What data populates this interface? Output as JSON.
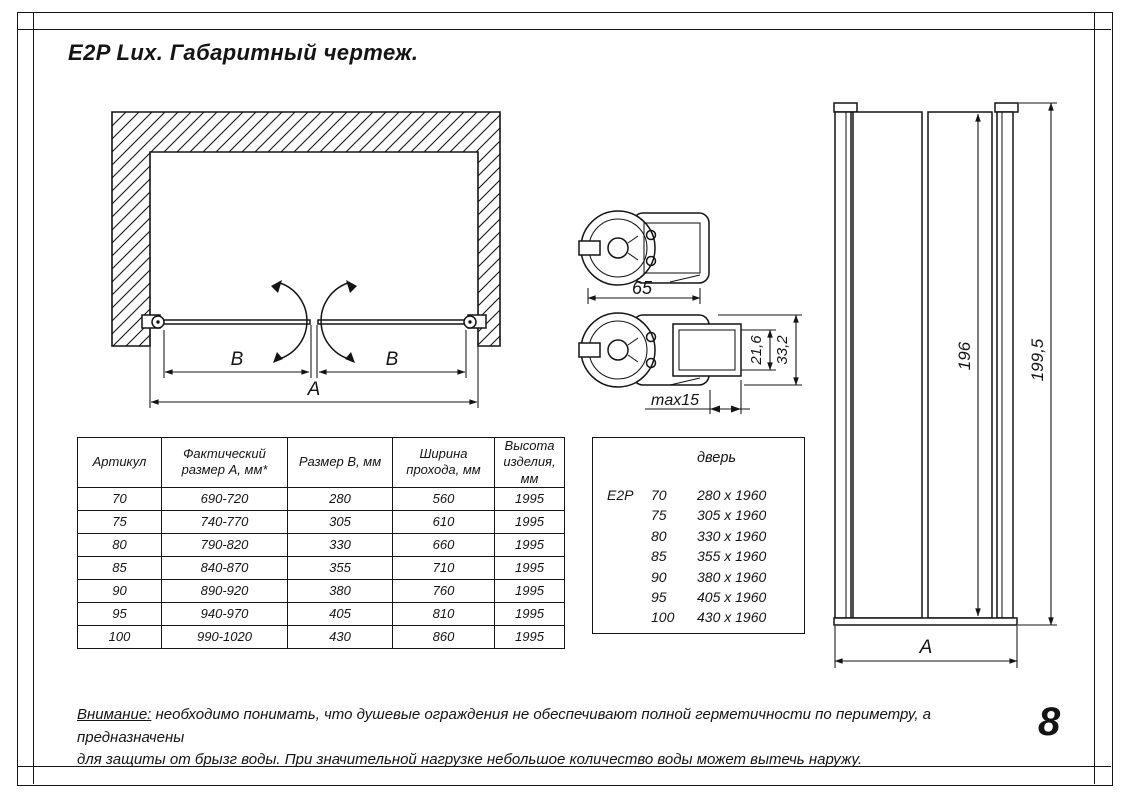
{
  "title": "E2P Lux. Габаритный чертеж.",
  "page_number": "8",
  "plan_view": {
    "dim_b_left": "B",
    "dim_b_right": "B",
    "dim_a": "A"
  },
  "profile_top": {
    "width_dim": "65"
  },
  "profile_bottom": {
    "inner_dim": "21,6",
    "outer_dim": "33,2",
    "adjust_dim": "max15"
  },
  "elevation": {
    "inner_height_dim": "196",
    "total_height_dim": "199,5",
    "width_dim": "A"
  },
  "spec_table": {
    "headers": [
      "Артикул",
      "Фактический размер А, мм*",
      "Размер В, мм",
      "Ширина прохода, мм",
      "Высота изделия, мм"
    ],
    "rows": [
      [
        "70",
        "690-720",
        "280",
        "560",
        "1995"
      ],
      [
        "75",
        "740-770",
        "305",
        "610",
        "1995"
      ],
      [
        "80",
        "790-820",
        "330",
        "660",
        "1995"
      ],
      [
        "85",
        "840-870",
        "355",
        "710",
        "1995"
      ],
      [
        "90",
        "890-920",
        "380",
        "760",
        "1995"
      ],
      [
        "95",
        "940-970",
        "405",
        "810",
        "1995"
      ],
      [
        "100",
        "990-1020",
        "430",
        "860",
        "1995"
      ]
    ]
  },
  "door_table": {
    "header": "дверь",
    "series": "E2P",
    "rows": [
      {
        "size": "70",
        "dims": "280 x 1960"
      },
      {
        "size": "75",
        "dims": "305 x 1960"
      },
      {
        "size": "80",
        "dims": "330 x 1960"
      },
      {
        "size": "85",
        "dims": "355 x 1960"
      },
      {
        "size": "90",
        "dims": "380 x 1960"
      },
      {
        "size": "95",
        "dims": "405 x 1960"
      },
      {
        "size": "100",
        "dims": "430 x 1960"
      }
    ]
  },
  "warning": {
    "label": "Внимание:",
    "line1": " необходимо понимать, что душевые ограждения не обеспечивают полной герметичности по периметру, а предназначены",
    "line2": "для защиты от брызг воды. При значительной нагрузке небольшое количество воды может вытечь наружу."
  }
}
